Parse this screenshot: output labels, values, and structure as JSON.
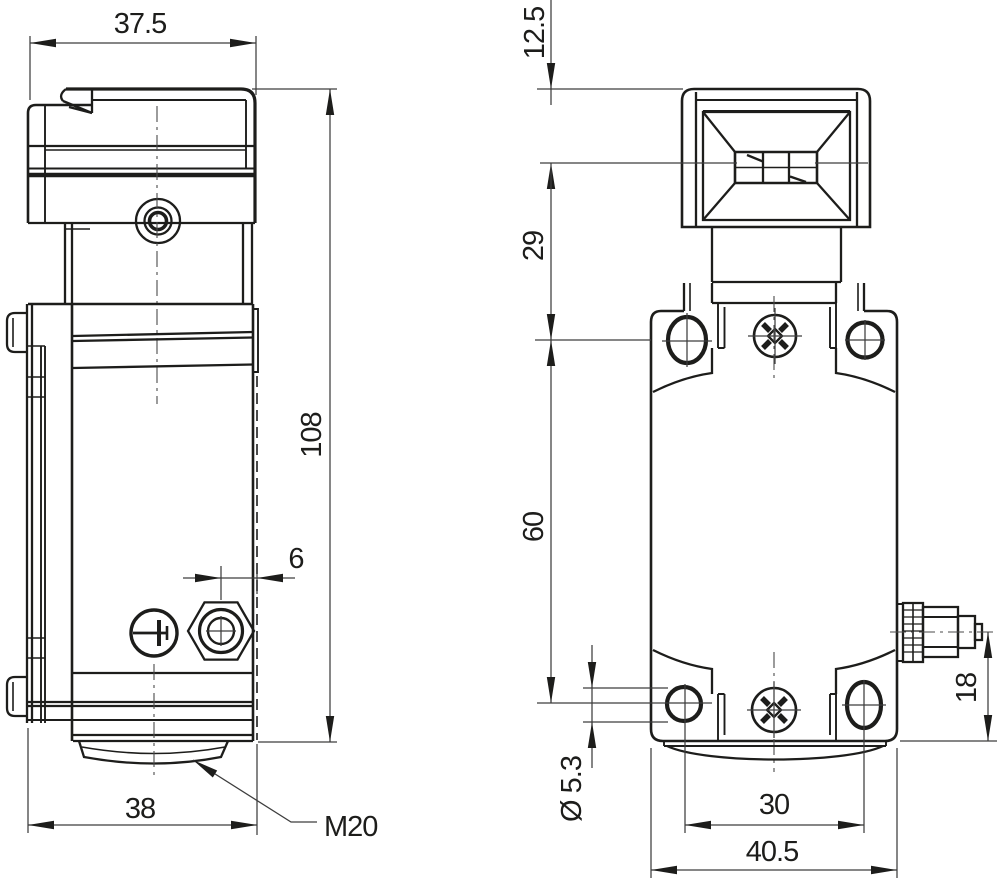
{
  "colors": {
    "line": "#1d1d1b",
    "dim_line": "#3d3d3d",
    "background": "#ffffff"
  },
  "side_view": {
    "dim_head_width": "37.5",
    "dim_overall_height": "108",
    "dim_gland_to_face": "6",
    "dim_base_width": "38",
    "gland_thread_label": "M20"
  },
  "front_view": {
    "dim_head_top_to_aperture": "12.5",
    "dim_aperture_to_flange": "29",
    "dim_flange_to_hole_center": "60",
    "dim_mounting_hole_diameter": "Ø 5.3",
    "dim_hole_center_to_bottom": "18",
    "dim_hole_spacing": "30",
    "dim_body_width": "40.5"
  }
}
